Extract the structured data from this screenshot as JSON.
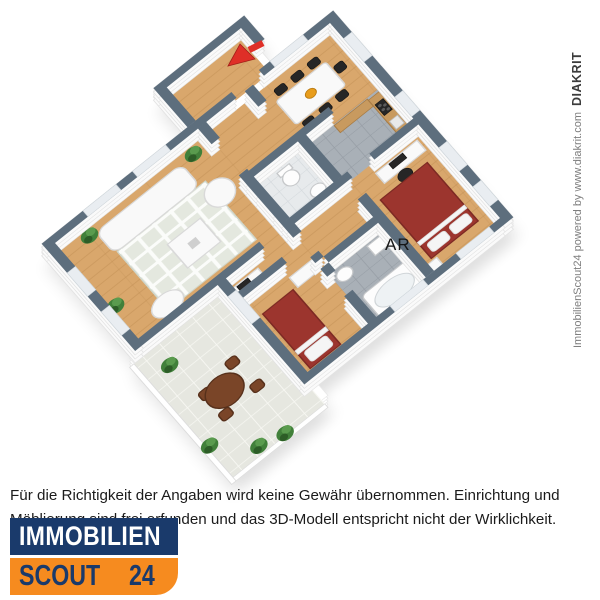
{
  "floorplan": {
    "label_ar": "AR"
  },
  "credit": {
    "prefix": "ImmobilienScout24 powered by www.diakrit.com",
    "brand": "DIAKRIT"
  },
  "disclaimer": "Für die Richtigkeit der Angaben wird keine Gewähr übernommen. Einrichtung und Möblierung sind frei erfunden und das 3D-Modell entspricht nicht der Wirklichkeit.",
  "logo": {
    "line1": "IMMOBILIEN",
    "line2_word": "SCOUT",
    "line2_number": "24"
  },
  "colors": {
    "wall_top": "#5d6e7d",
    "wood": "#d9a76c",
    "wood_line": "#c08d52",
    "tile": "#a9b0b7",
    "tile_line": "#959ca4",
    "wc_tile": "#e7eaec",
    "wc_line": "#d3d8dc",
    "terrace": "#e6e7e0",
    "terrace_line": "#f7f7f2",
    "bed_red": "#9c352e",
    "arrow_red": "#df2f27",
    "brown": "#7a4528",
    "plant": "#41803a",
    "logo_navy": "#1a3a6b",
    "logo_orange": "#f68b1f",
    "credit_gray": "#7e7e7e",
    "text_color": "#1b1b1b"
  }
}
